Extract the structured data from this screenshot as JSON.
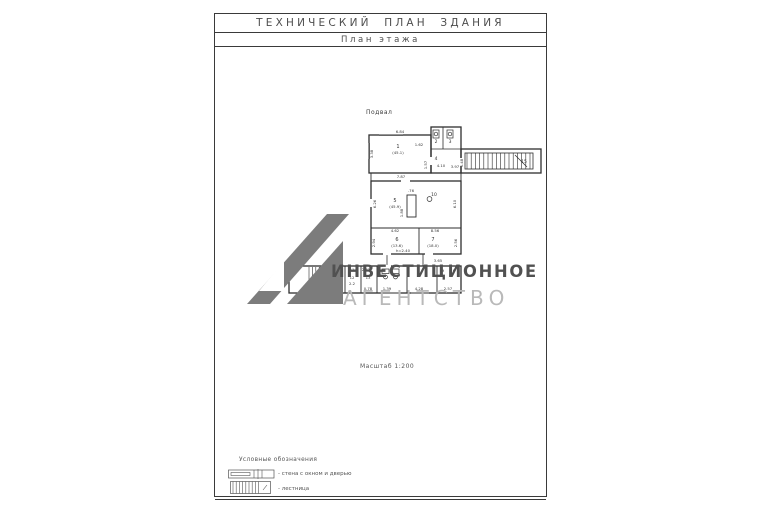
{
  "page": {
    "title": "ТЕХНИЧЕСКИЙ ПЛАН ЗДАНИЯ",
    "subtitle": "План этажа",
    "scale_label": "Масштаб 1:200"
  },
  "plan": {
    "floor_label": "Подвал",
    "labels": [
      {
        "t": "6.84",
        "x": 117,
        "y": 14
      },
      {
        "t": "1",
        "x": 115,
        "y": 29,
        "s": 5
      },
      {
        "t": "(45.1)",
        "x": 115,
        "y": 35
      },
      {
        "t": "3.38",
        "x": 90,
        "y": 35,
        "r": -90
      },
      {
        "t": "1.57",
        "x": 144,
        "y": 46,
        "r": -90
      },
      {
        "t": "1.62",
        "x": 136,
        "y": 27
      },
      {
        "t": "2",
        "x": 153,
        "y": 24,
        "s": 4.5
      },
      {
        "t": "3",
        "x": 167,
        "y": 24,
        "s": 4.5
      },
      {
        "t": "4",
        "x": 153,
        "y": 41,
        "s": 4.5
      },
      {
        "t": "4.10",
        "x": 158,
        "y": 48
      },
      {
        "t": "3.97",
        "x": 172,
        "y": 49
      },
      {
        "t": "1.48",
        "x": 180,
        "y": 44,
        "r": -90
      },
      {
        "t": "15",
        "x": 241,
        "y": 44,
        "s": 4.5
      },
      {
        "t": "7.87",
        "x": 118,
        "y": 59
      },
      {
        "t": "5",
        "x": 112,
        "y": 83,
        "s": 5
      },
      {
        "t": "(45.9)",
        "x": 112,
        "y": 89
      },
      {
        "t": "6.26",
        "x": 93,
        "y": 85,
        "r": -90
      },
      {
        "t": "6.10",
        "x": 173,
        "y": 85,
        "r": -90
      },
      {
        "t": ".76",
        "x": 128,
        "y": 73
      },
      {
        "t": "1.88",
        "x": 120,
        "y": 94,
        "r": -90
      },
      {
        "t": "10",
        "x": 151,
        "y": 77,
        "s": 4.5
      },
      {
        "t": "4.62",
        "x": 112,
        "y": 113
      },
      {
        "t": "2.94",
        "x": 92,
        "y": 124,
        "r": -90
      },
      {
        "t": "6",
        "x": 114,
        "y": 122,
        "s": 5
      },
      {
        "t": "(13.6)",
        "x": 114,
        "y": 128
      },
      {
        "t": "h=2.40",
        "x": 120,
        "y": 133
      },
      {
        "t": "7",
        "x": 150,
        "y": 122,
        "s": 5
      },
      {
        "t": "(18.0)",
        "x": 150,
        "y": 128
      },
      {
        "t": "8.56",
        "x": 152,
        "y": 113
      },
      {
        "t": "2.56",
        "x": 174,
        "y": 124,
        "r": -90
      },
      {
        "t": "3.65",
        "x": 155,
        "y": 143
      },
      {
        "t": "5.89",
        "x": 48,
        "y": 146
      },
      {
        "t": "14",
        "x": 36,
        "y": 155,
        "s": 4.5
      },
      {
        "t": "(3.4)",
        "x": 36,
        "y": 161
      },
      {
        "t": "4.4",
        "x": 36,
        "y": 167
      },
      {
        "t": "11",
        "x": 69,
        "y": 152
      },
      {
        "t": "2.43",
        "x": 83,
        "y": 152
      },
      {
        "t": "12",
        "x": 69,
        "y": 160
      },
      {
        "t": "2.2",
        "x": 69,
        "y": 166
      },
      {
        "t": "13",
        "x": 85,
        "y": 160
      },
      {
        "t": "0.78",
        "x": 85,
        "y": 171
      },
      {
        "t": "1.39",
        "x": 104,
        "y": 171
      },
      {
        "t": "4.28",
        "x": 136,
        "y": 171
      },
      {
        "t": "2.57",
        "x": 165,
        "y": 171
      },
      {
        "t": "9",
        "x": 160,
        "y": 153
      },
      {
        "t": "8",
        "x": 171,
        "y": 153
      }
    ]
  },
  "watermark": {
    "line1": "ИНВЕСТИЦИОННОЕ",
    "line2": "АГЕНТСТВО",
    "logo_color": "#7c7c7c",
    "line1_color": "#515151",
    "line2_color": "#b9b9b9"
  },
  "legend": {
    "heading": "Условные обозначения",
    "items": [
      {
        "icon": "wall-window-door-symbol",
        "label": "- стена с окном и дверью"
      },
      {
        "icon": "staircase-symbol",
        "label": "- лестница"
      }
    ]
  },
  "colors": {
    "frame_line": "#3a3a3a",
    "plan_line": "#2e2e2e",
    "text": "#4d4d4d"
  }
}
